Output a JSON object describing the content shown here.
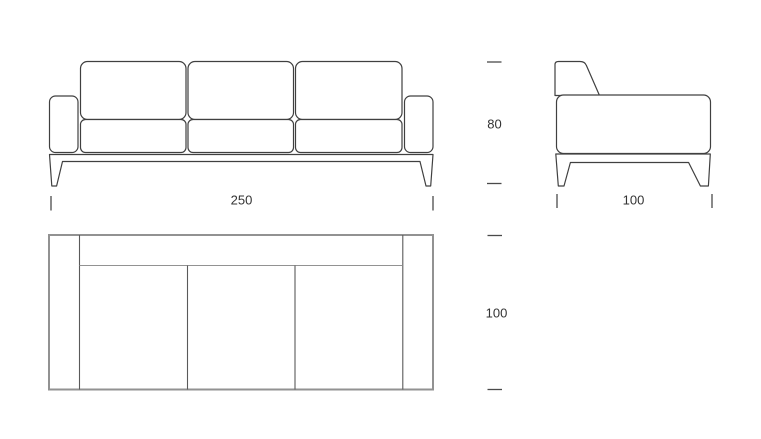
{
  "colors": {
    "line": "#404040",
    "light_line": "#929292",
    "text": "#333333",
    "background": "#ffffff"
  },
  "dimensions": {
    "front_width": "250",
    "side_depth": "100",
    "height": "80",
    "top_depth": "100"
  }
}
